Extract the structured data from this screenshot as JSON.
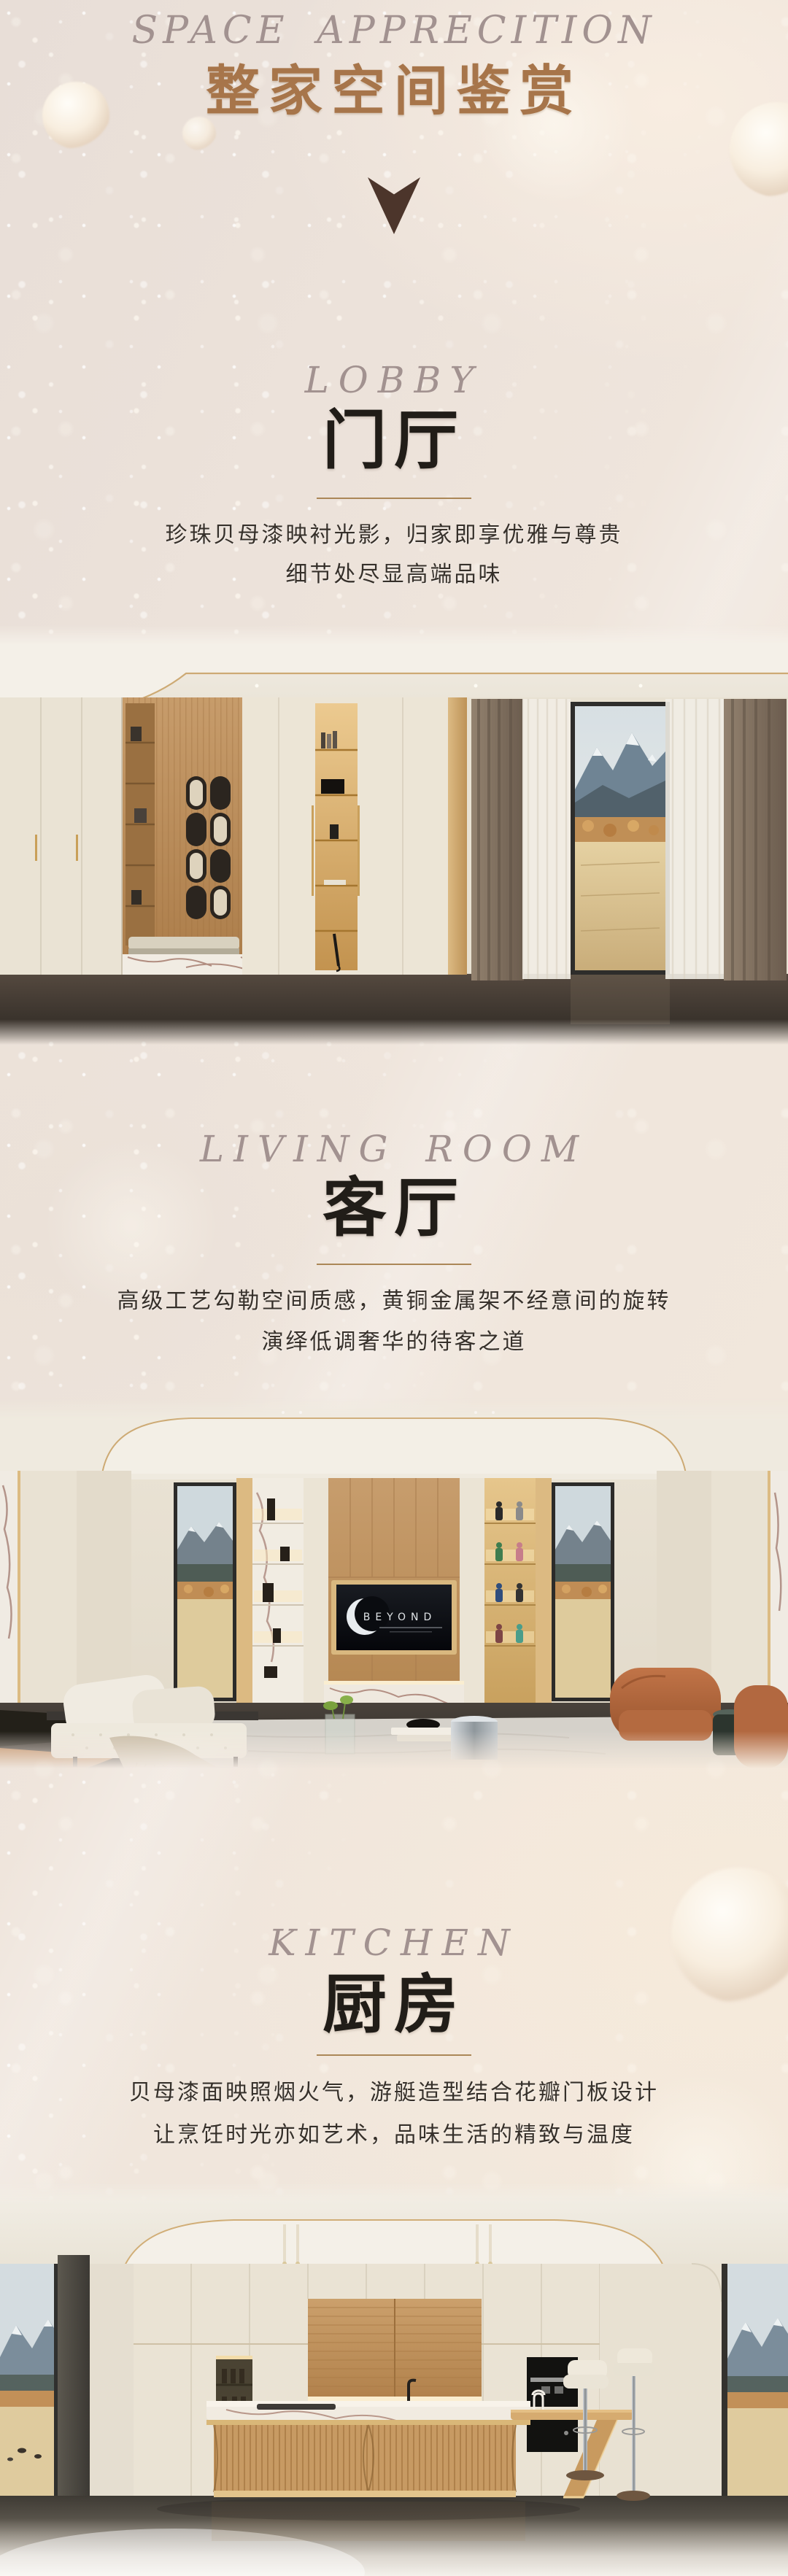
{
  "header": {
    "subtitle_en": "SPACE APPRECITION",
    "title_cn": "整家空间鉴赏"
  },
  "icons": {
    "down_arrow": {
      "name": "down-arrow-icon",
      "glyph": "▼",
      "color": "#4c352b"
    }
  },
  "sections": [
    {
      "id": "lobby",
      "en": "LOBBY",
      "cn": "门厅",
      "desc1": "珍珠贝母漆映衬光影，归家即享优雅与尊贵",
      "desc2": "细节处尽显高端品味"
    },
    {
      "id": "living-room",
      "en": "LIVING ROOM",
      "cn": "客厅",
      "desc1": "高级工艺勾勒空间质感，黄铜金属架不经意间的旋转",
      "desc2": "演绎低调奢华的待客之道"
    },
    {
      "id": "kitchen",
      "en": "KITCHEN",
      "cn": "厨房",
      "desc1": "贝母漆面映照烟火气，游艇造型结合花瓣门板设计",
      "desc2": "让烹饪时光亦如艺术，品味生活的精致与温度"
    }
  ],
  "photos": {
    "living_room": {
      "tv_text": "BEYOND"
    }
  },
  "colors": {
    "title_gold": "#a7754a",
    "script_gray": "#a29290",
    "heading_dark": "#211d18",
    "body_text": "#36302a",
    "divider_gold": "#ab8757",
    "arrow_brown": "#4c352b",
    "background_pearl": "#efe5da",
    "accent_brass": "#c9a96a"
  }
}
